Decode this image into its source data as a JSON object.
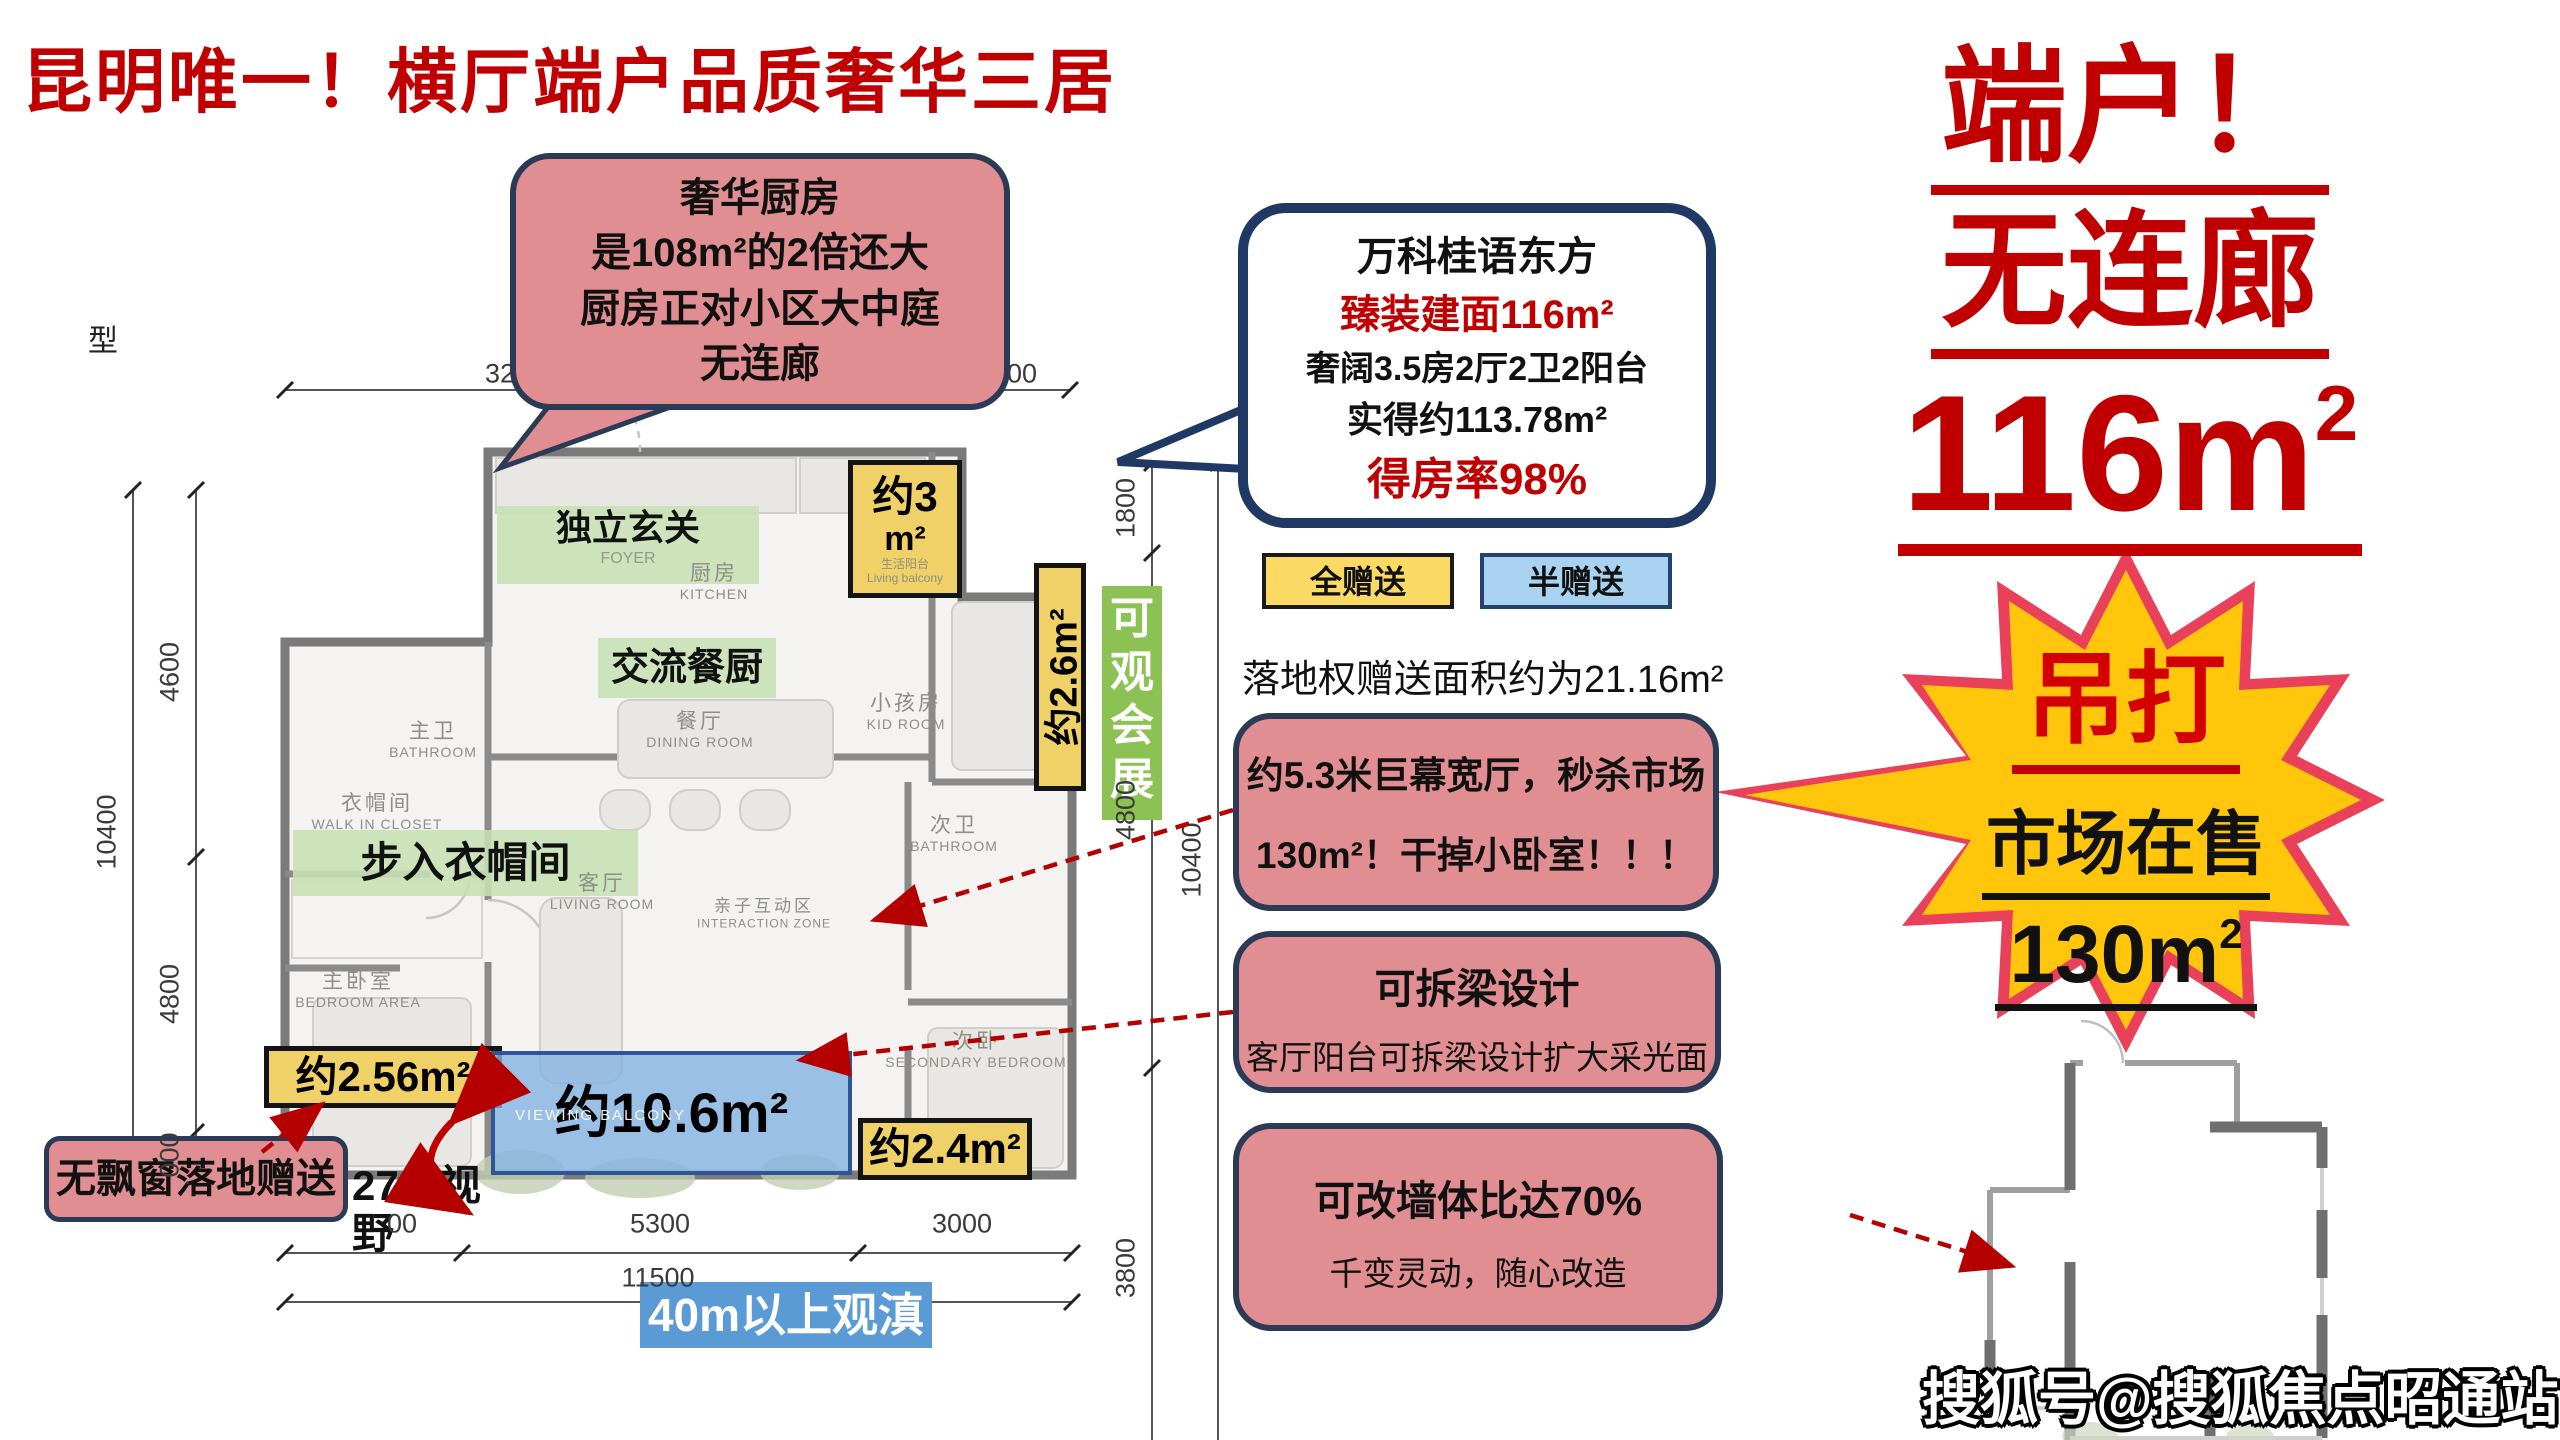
{
  "page": {
    "title": "昆明唯一！横厅端户品质奢华三居",
    "type_char": "型",
    "watermark": "搜狐号@搜狐焦点昭通站"
  },
  "kitchen_callout": {
    "lines": [
      "奢华厨房",
      "是108m²的2倍还大",
      "厨房正对小区大中庭",
      "无连廊"
    ]
  },
  "project_bubble": {
    "name": "万科桂语东方",
    "area_line": "臻装建面116m²",
    "layout_line": "奢阔3.5房2厅2卫2阳台",
    "actual_line": "实得约113.78m²",
    "rate_line": "得房率98%"
  },
  "legend": {
    "full_gift": "全赠送",
    "half_gift": "半赠送",
    "note": "落地权赠送面积约为21.16m²"
  },
  "feature_boxes": {
    "wide_hall": {
      "line1": "约5.3米巨幕宽厅，秒杀市场",
      "line2": "130m²！干掉小卧室！！！"
    },
    "beam": {
      "title": "可拆梁设计",
      "subtitle": "客厅阳台可拆梁设计扩大采光面"
    },
    "wall": {
      "title": "可改墙体比达70%",
      "subtitle": "千变灵动，随心改造"
    }
  },
  "right_banner": {
    "line1": "端户！",
    "line2": "无连廊",
    "area_num": "116",
    "area_unit": "m",
    "area_sup": "2"
  },
  "starburst": {
    "line1": "吊打",
    "line2": "市场在售",
    "area_num": "130",
    "area_unit": "m",
    "area_sup": "2"
  },
  "floorplan": {
    "marketing": {
      "foyer": "独立玄关",
      "dining_kitchen": "交流餐厨",
      "walk_in_closet": "步入衣帽间",
      "no_bay_window": "无飘窗落地赠送",
      "view_270_l1": "270°视",
      "view_270_l2": "野",
      "view_badge": "40m以上观滇",
      "expo_view": "可观会展"
    },
    "rooms": {
      "kitchen": {
        "cn": "厨房",
        "en": "KITCHEN"
      },
      "dining": {
        "cn": "餐厅",
        "en": "DINING ROOM"
      },
      "living": {
        "cn": "客厅",
        "en": "LIVING ROOM"
      },
      "interaction": {
        "cn": "亲子互动区",
        "en": "INTERACTION ZONE"
      },
      "foyer_en": "FOYER",
      "master_bath": {
        "cn": "主卫",
        "en": "BATHROOM"
      },
      "closet": {
        "cn": "衣帽间",
        "en": "WALK IN CLOSET"
      },
      "master_bed": {
        "cn": "主卧室",
        "en": "BEDROOM AREA"
      },
      "kid": {
        "cn": "小孩房",
        "en": "KID ROOM"
      },
      "second_bath": {
        "cn": "次卫",
        "en": "BATHROOM"
      },
      "second_bed": {
        "cn": "次卧",
        "en": "SECONDARY BEDROOM"
      },
      "living_balcony": {
        "cn": "生活阳台",
        "en": "Living balcony"
      },
      "view_balcony_en": "VIEWING BALCONY"
    },
    "tags": {
      "top_balcony_l1": "约3",
      "top_balcony_l2": "m²",
      "side": "约2.6m²",
      "corner_left": "约2.56m²",
      "corner_right": "约2.4m²",
      "view_balcony": "约10.6m²"
    },
    "dims": {
      "top": [
        "3200",
        "00"
      ],
      "left": [
        "4600",
        "4800",
        "000"
      ],
      "left_total": "10400",
      "right": [
        "1800",
        "4800",
        "3800"
      ],
      "right_total": "10400",
      "bottom": [
        "00",
        "5300",
        "3000"
      ],
      "bottom_total": "11500"
    }
  },
  "colors": {
    "accent_red": "#C00000",
    "callout_pink": "#E08E92",
    "border_navy": "#2B3A55",
    "tag_yellow": "#EFD167",
    "legend_yellow": "#FBD965",
    "legend_blue": "#A9D2F0",
    "balcony_blue": "#84B4E2",
    "green_badge": "#8CC153",
    "green_band": "#C6E0B4",
    "star_yellow": "#FFC60B",
    "star_red": "#E9415A",
    "view_badge_blue": "#5B9BD5"
  }
}
